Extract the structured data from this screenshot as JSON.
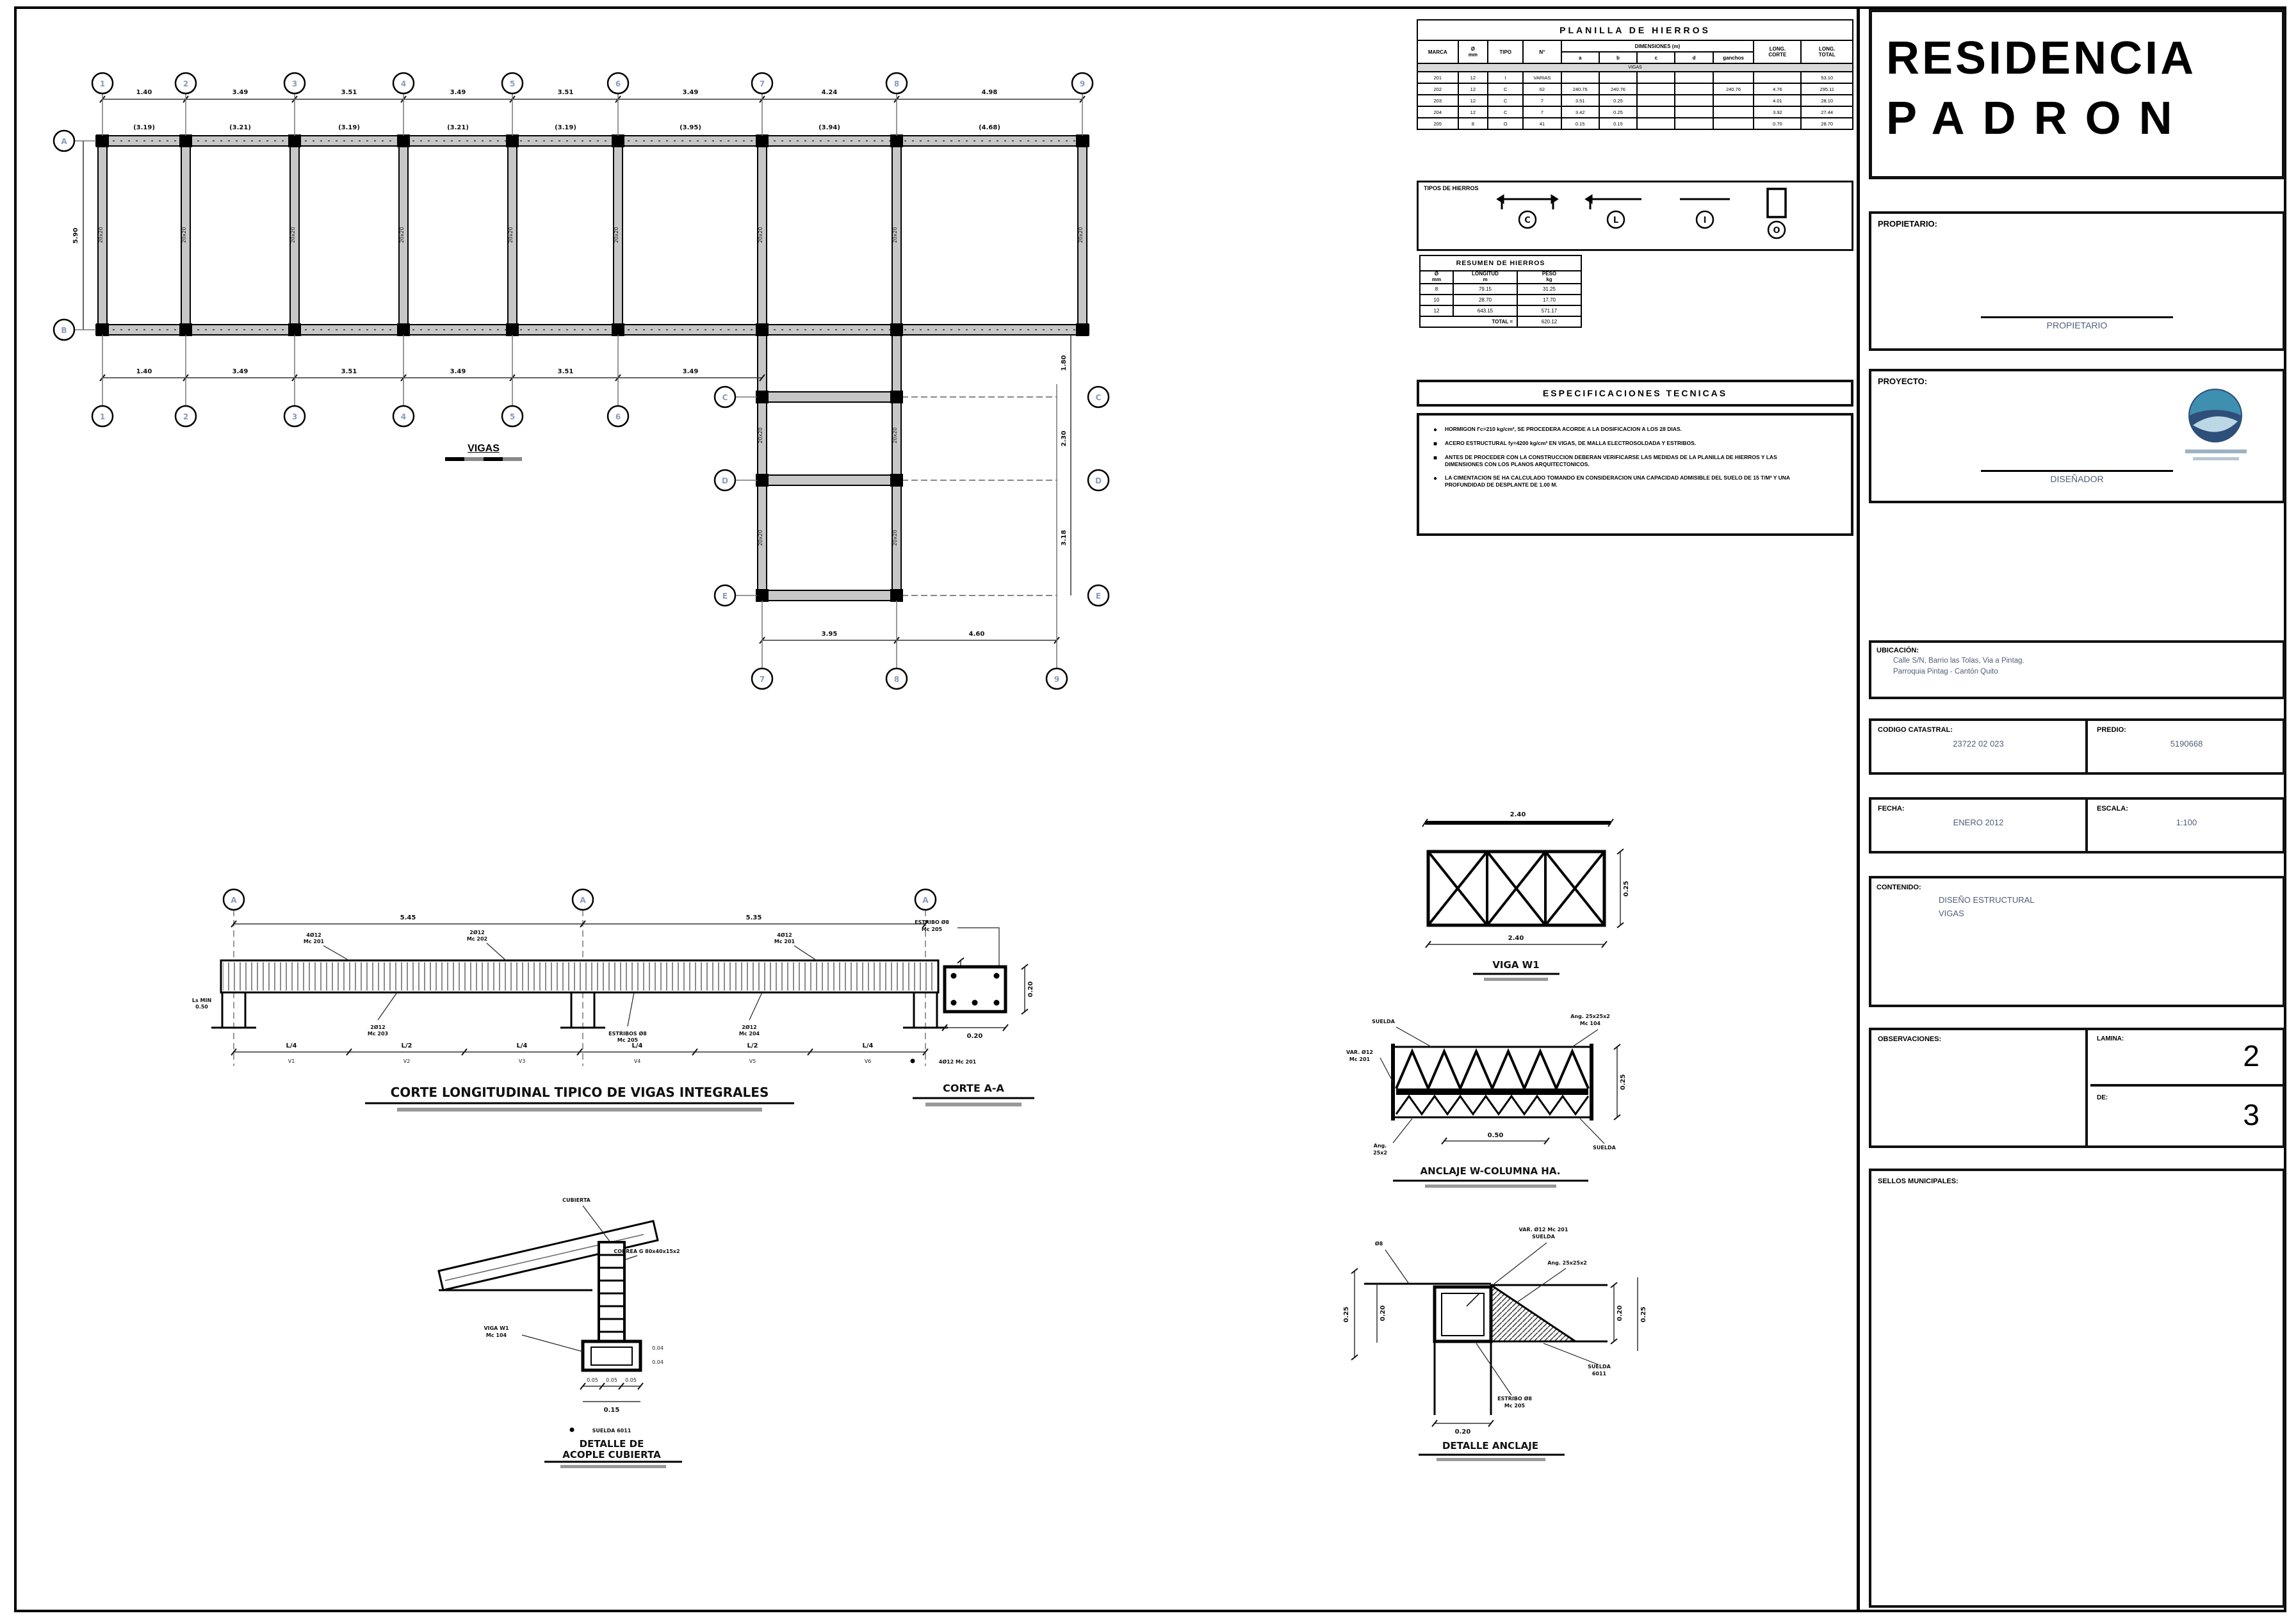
{
  "sheet": {
    "title_line1": "RESIDENCIA",
    "title_line2": "PADRON"
  },
  "titleblock": {
    "propietario_label": "PROPIETARIO:",
    "propietario_sign": "PROPIETARIO",
    "proyecto_label": "PROYECTO:",
    "disenador_sign": "DISEÑADOR",
    "ubicacion_label": "UBICACIÓN:",
    "ubicacion_line1": "Calle S/N, Barrio las Tolas, Via a Pintag.",
    "ubicacion_line2": "Parroquia Pintag - Cantón Quito",
    "codigo_label": "CODIGO CATASTRAL:",
    "codigo_value": "23722 02 023",
    "predio_label": "PREDIO:",
    "predio_value": "5190668",
    "fecha_label": "FECHA:",
    "fecha_value": "ENERO 2012",
    "escala_label": "ESCALA:",
    "escala_value": "1:100",
    "contenido_label": "CONTENIDO:",
    "contenido_line1": "DISEÑO ESTRUCTURAL",
    "contenido_line2": "VIGAS",
    "observaciones_label": "OBSERVACIONES:",
    "lamina_label": "LAMINA:",
    "lamina_value": "2",
    "de_label": "DE:",
    "de_value": "3",
    "sellos_label": "SELLOS MUNICIPALES:"
  },
  "planilla": {
    "title": "PLANILLA  DE  HIERROS",
    "headers": {
      "marca": "MARCA",
      "diam_a": "Ø",
      "diam_b": "mm",
      "tipo": "TIPO",
      "num": "N°",
      "dims_group": "DIMENSIONES  (m)",
      "sub": [
        "a",
        "b",
        "c",
        "d",
        "ganchos"
      ],
      "lc_a": "LONG.",
      "lc_b": "CORTE",
      "lt_a": "LONG.",
      "lt_b": "TOTAL",
      "band": "VIGAS"
    },
    "rows": [
      [
        "201",
        "12",
        "I",
        "VARIAS",
        "",
        "",
        "",
        "",
        "",
        "",
        "53.10"
      ],
      [
        "202",
        "12",
        "C",
        "62",
        "240.76",
        "240.76",
        "",
        "",
        "240.76",
        "4.76",
        "295.11"
      ],
      [
        "203",
        "12",
        "C",
        "7",
        "3.51",
        "0.25",
        "",
        "",
        "",
        "4.01",
        "28.10"
      ],
      [
        "204",
        "12",
        "C",
        "7",
        "3.42",
        "0.25",
        "",
        "",
        "",
        "3.92",
        "27.44"
      ],
      [
        "205",
        "8",
        "O",
        "41",
        "0.15",
        "0.15",
        "",
        "",
        "",
        "0.70",
        "28.70"
      ]
    ]
  },
  "tipos": {
    "label": "TIPOS  DE  HIERROS",
    "letters": [
      "C",
      "L",
      "I",
      "O"
    ]
  },
  "resumen": {
    "title": "RESUMEN  DE  HIERROS",
    "h": [
      [
        "Ø",
        "mm"
      ],
      [
        "LONGITUD",
        "m"
      ],
      [
        "PESO",
        "kg"
      ]
    ],
    "rows": [
      [
        "8",
        "79.15",
        "31.25"
      ],
      [
        "10",
        "28.70",
        "17.70"
      ],
      [
        "12",
        "643.15",
        "571.17"
      ]
    ],
    "total_label": "TOTAL =",
    "total_value": "620.12"
  },
  "especificaciones": {
    "title": "ESPECIFICACIONES  TECNICAS",
    "bullets": [
      "HORMIGON f'c=210 kg/cm², SE PROCEDERA ACORDE A LA DOSIFICACION A LOS 28 DIAS.",
      "ACERO ESTRUCTURAL fy=4200 kg/cm² EN VIGAS, DE MALLA ELECTROSOLDADA Y ESTRIBOS.",
      "ANTES DE PROCEDER CON LA CONSTRUCCION DEBERAN VERIFICARSE LAS MEDIDAS DE LA PLANILLA DE HIERROS Y LAS DIMENSIONES CON LOS PLANOS ARQUITECTONICOS.",
      "LA CIMENTACION SE HA CALCULADO TOMANDO EN CONSIDERACION UNA CAPACIDAD ADMISIBLE DEL SUELO DE 15 T/M² Y UNA PROFUNDIDAD DE DESPLANTE DE 1.00 M."
    ]
  },
  "plan": {
    "caption": "VIGAS",
    "grid_top": [
      "1",
      "2",
      "3",
      "4",
      "5",
      "6",
      "7",
      "8",
      "9"
    ],
    "grid_left": [
      "A",
      "B"
    ],
    "grid_bottom_band": [
      "1",
      "2",
      "3",
      "4",
      "5",
      "6",
      "7"
    ],
    "grid_ext_left": [
      "C",
      "D",
      "E"
    ],
    "grid_ext_right": [
      "C",
      "D",
      "E"
    ],
    "grid_ext_bottom": [
      "7",
      "8",
      "9"
    ],
    "dims_top": [
      "1.40",
      "3.49",
      "3.51",
      "3.49",
      "3.51",
      "3.49",
      "4.24",
      "4.98"
    ],
    "dims_beam": [
      "(3.19)",
      "(3.21)",
      "(3.19)",
      "(3.21)",
      "(3.19)",
      "(3.95)",
      "(3.94)",
      "(4.68)"
    ],
    "dims_bottom": [
      "1.40",
      "3.49",
      "3.51",
      "3.49",
      "3.51",
      "3.49"
    ],
    "dims_ext_bottom": [
      "3.95",
      "4.60"
    ],
    "dims_ext_right": [
      "1.80",
      "2.30",
      "3.18"
    ],
    "dim_left": "5.90",
    "column_tag": "20x20"
  },
  "section": {
    "title": "CORTE  LONGITUDINAL  TIPICO  DE  VIGAS  INTEGRALES",
    "bubbles": [
      "A",
      "A",
      "A"
    ],
    "dims_top": [
      "5.45",
      "5.35"
    ],
    "ann_top": [
      [
        "4Ø12",
        "Mc 201"
      ],
      [
        "2Ø12",
        "Mc 202"
      ],
      [
        "4Ø12",
        "Mc 201"
      ]
    ],
    "ann_bottom": [
      [
        "2Ø12",
        "Mc 203"
      ],
      [
        "ESTRIBOS Ø8",
        "Mc 205"
      ],
      [
        "2Ø12",
        "Mc 204"
      ]
    ],
    "dims_bottom": [
      "L/4",
      "L/2",
      "L/4",
      "L/4",
      "L/2",
      "L/4"
    ],
    "seg_labels": [
      "V1",
      "V2",
      "V3",
      "V4",
      "V5",
      "V6"
    ],
    "left_note": [
      "Ls MIN",
      "0.50"
    ],
    "dim_right": "0.20"
  },
  "corte_aa": {
    "label": [
      "ESTRIBO Ø8",
      "Mc 205"
    ],
    "dim_right": "0.20",
    "dim_bottom": "0.20",
    "note": "4Ø12 Mc 201",
    "title": "CORTE  A-A"
  },
  "acople": {
    "label_top": "CUBIERTA",
    "label_right": "CORREA G 80x40x15x2",
    "label_left": [
      "VIGA W1",
      "Mc 104"
    ],
    "dims_right": [
      "0.04",
      "0.04"
    ],
    "dims_bottom": [
      "0.05",
      "0.05",
      "0.05"
    ],
    "dim_total": "0.15",
    "note": "SUELDA 6011",
    "title": [
      "DETALLE  DE",
      "ACOPLE  CUBIERTA"
    ]
  },
  "viga_w1": {
    "dim_top": "2.40",
    "dim_right": "0.25",
    "dim_bottom": "2.40",
    "title": "VIGA  W1"
  },
  "anclaje": {
    "label_weld_left": "SUELDA",
    "label_var": [
      "VAR. Ø12",
      "Mc 201"
    ],
    "label_ang_left": [
      "Ang.",
      "25x2"
    ],
    "label_ang_right": [
      "Ang. 25x25x2",
      "Mc 104"
    ],
    "label_weld_right": "SUELDA",
    "dim_right": "0.25",
    "dim_bottom": "0.50",
    "title": "ANCLAJE  W-COLUMNA  HA."
  },
  "det_anclaje": {
    "label_d8": "Ø8",
    "label_var": [
      "VAR. Ø12 Mc 201",
      "SUELDA"
    ],
    "label_ang": "Ang. 25x25x2",
    "label_weld": [
      "SUELDA",
      "6011"
    ],
    "label_estribo": [
      "ESTRIBO Ø8",
      "Mc 205"
    ],
    "dim_left_a": "0.25",
    "dim_left_b": "0.20",
    "dim_right_a": "0.20",
    "dim_right_b": "0.25",
    "dim_bottom": "0.20",
    "title": "DETALLE  ANCLAJE"
  }
}
